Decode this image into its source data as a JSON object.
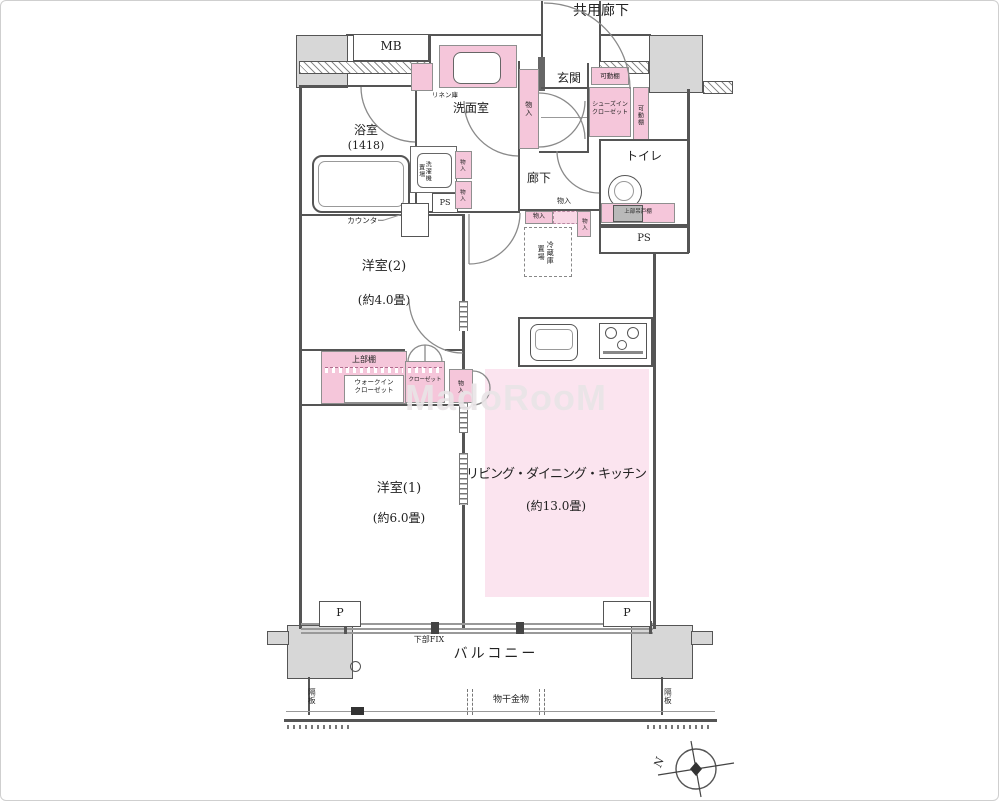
{
  "colors": {
    "storage_pink": "#f5c6da",
    "ldk_pink": "#fbe4ef",
    "wall_gray": "#555555",
    "pillar_gray": "#d7d7d7"
  },
  "labels": {
    "common_corridor": "共用廊下",
    "mb": "MB",
    "genkan": "玄関",
    "kadou_tana": "可動棚",
    "shoes_closet": "シューズイン\nクローゼット",
    "monoire": "物入",
    "linen": "リネン庫",
    "washroom": "洗面室",
    "bath_name": "浴室",
    "bath_size": "(1418)",
    "washer": "洗濯機\n置場",
    "ps": "PS",
    "counter": "カウンター",
    "hallway": "廊下",
    "toilet": "トイレ",
    "upper_cupboard": "上部吊戸棚",
    "fridge": "冷蔵庫\n置場",
    "bedroom2_name": "洋室(2)",
    "bedroom2_size": "(約4.0畳)",
    "upper_shelf": "上部棚",
    "wic": "ウォークイン\nクローゼット",
    "closet": "クローゼット",
    "bedroom1_name": "洋室(1)",
    "bedroom1_size": "(約6.0畳)",
    "ldk_name": "リビング・ダイニング・キッチン",
    "ldk_size": "(約13.0畳)",
    "p": "P",
    "lower_fix": "下部FIX",
    "balcony": "バルコニー",
    "partition": "隔板",
    "laundry_hook": "物干金物",
    "north": "N",
    "watermark": "MadoRooM"
  }
}
